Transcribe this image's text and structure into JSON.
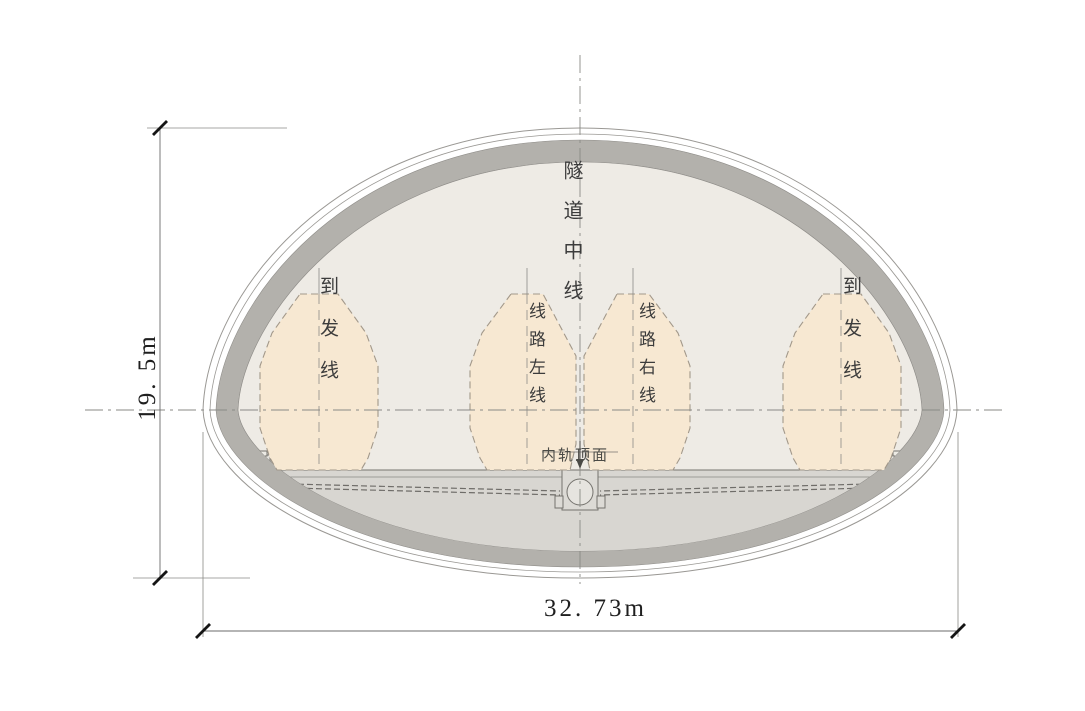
{
  "diagram": {
    "type": "tunnel-cross-section",
    "dimensions": {
      "height_label": "19. 5m",
      "width_label": "32. 73m"
    },
    "labels": {
      "tunnel_centerline": "隧道中线",
      "rail_top_surface": "内轨顶面"
    },
    "envelopes": [
      {
        "id": "arrival-departure-left",
        "label": "到发线"
      },
      {
        "id": "line-left",
        "label": "线路左线"
      },
      {
        "id": "line-right",
        "label": "线路右线"
      },
      {
        "id": "arrival-departure-right",
        "label": "到发线"
      }
    ],
    "colors": {
      "band": "#b3b1ac",
      "interior": "#eeebe5",
      "slab": "#d8d6d1",
      "env": "#f7e8d2",
      "env_stroke": "#a2988a",
      "line_light": "#9a9894"
    }
  }
}
